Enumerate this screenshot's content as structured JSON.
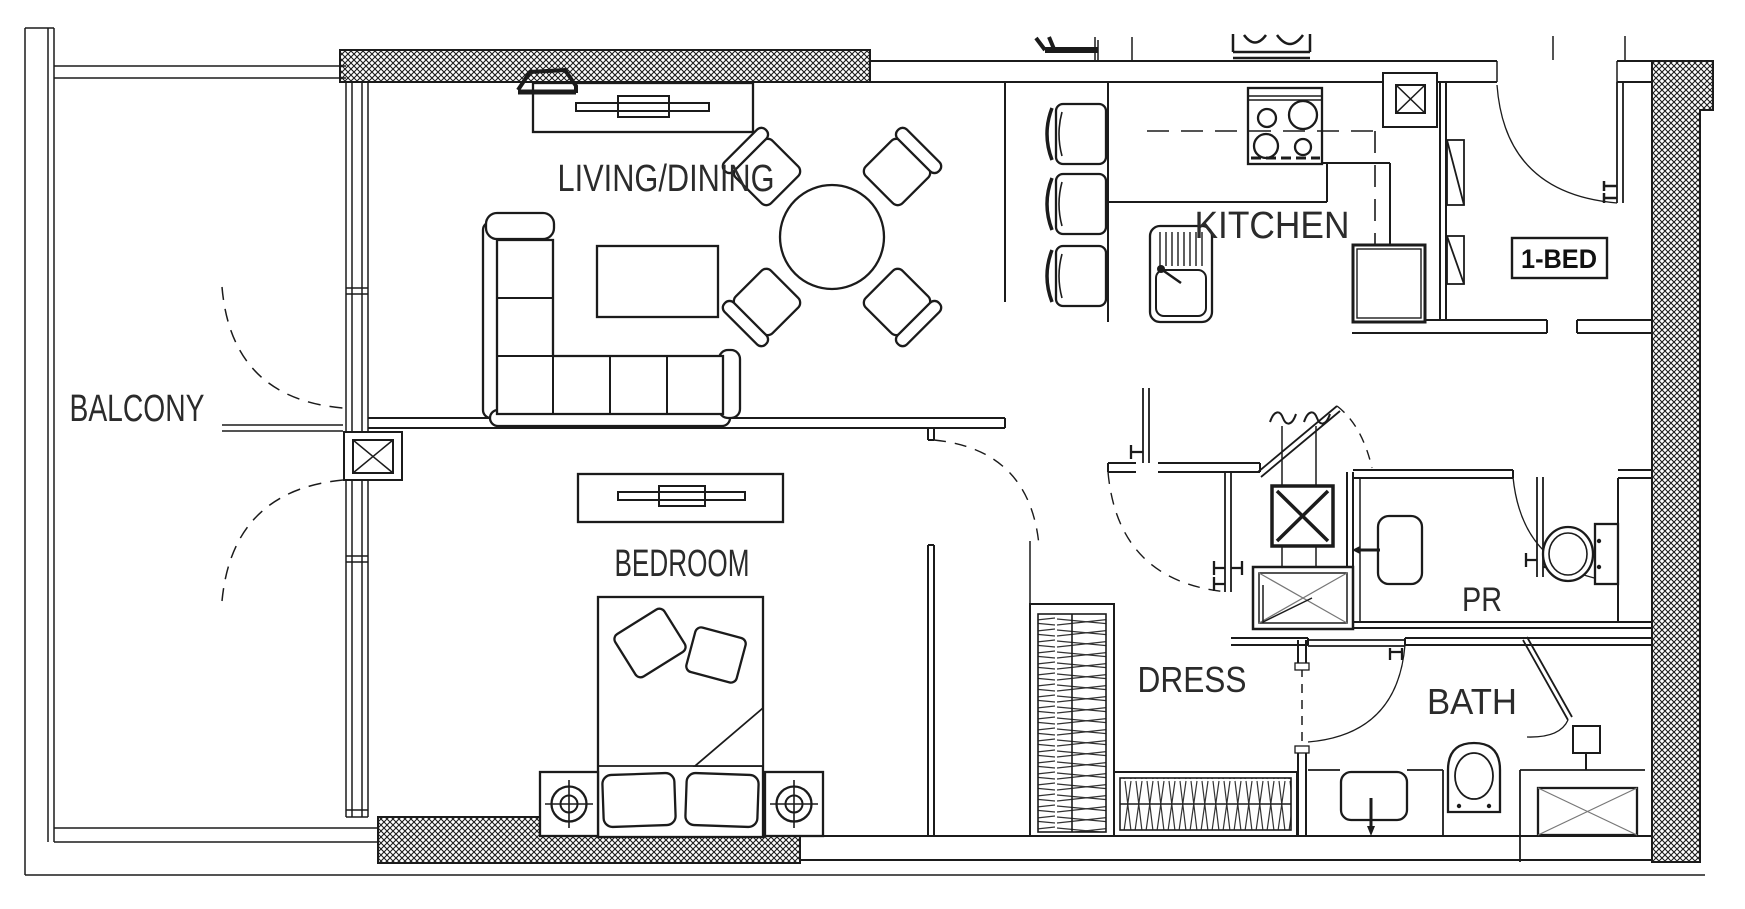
{
  "meta": {
    "title": "1-BED apartment floor plan",
    "canvas_width": 1745,
    "canvas_height": 909
  },
  "unit": {
    "tag_label": "1-BED"
  },
  "rooms": {
    "balcony": {
      "label": "BALCONY"
    },
    "living_dining": {
      "label": "LIVING/DINING"
    },
    "kitchen": {
      "label": "KITCHEN"
    },
    "bedroom": {
      "label": "BEDROOM"
    },
    "dress": {
      "label": "DRESS"
    },
    "powder_room": {
      "label": "PR"
    },
    "bath": {
      "label": "BATH"
    }
  },
  "colors": {
    "line": "#1b1b1b",
    "background": "#ffffff",
    "hatch": "#1b1b1b",
    "label": "#2b2b2b",
    "light_detail": "#777777"
  },
  "fixtures": [
    {
      "name": "tv-console-living"
    },
    {
      "name": "l-shaped-sofa"
    },
    {
      "name": "coffee-table"
    },
    {
      "name": "round-dining-table"
    },
    {
      "name": "dining-chair",
      "count": 4
    },
    {
      "name": "bar-stool",
      "count": 3
    },
    {
      "name": "kitchen-sink"
    },
    {
      "name": "cooktop-4-burner"
    },
    {
      "name": "refrigerator"
    },
    {
      "name": "overhead-cabinet-dashed"
    },
    {
      "name": "entry-door"
    },
    {
      "name": "shaft-column",
      "count": 2
    },
    {
      "name": "closet-panels-entry"
    },
    {
      "name": "duct-shaft-x"
    },
    {
      "name": "washing-machine"
    },
    {
      "name": "pr-vanity"
    },
    {
      "name": "pr-toilet"
    },
    {
      "name": "bath-vanity"
    },
    {
      "name": "bath-toilet"
    },
    {
      "name": "shower"
    },
    {
      "name": "shower-head"
    },
    {
      "name": "wardrobe-tall"
    },
    {
      "name": "wardrobe-low"
    },
    {
      "name": "double-bed"
    },
    {
      "name": "nightstand",
      "count": 2
    },
    {
      "name": "table-lamp",
      "count": 2
    },
    {
      "name": "dresser-tv-bedroom"
    },
    {
      "name": "balcony-french-doors"
    }
  ]
}
